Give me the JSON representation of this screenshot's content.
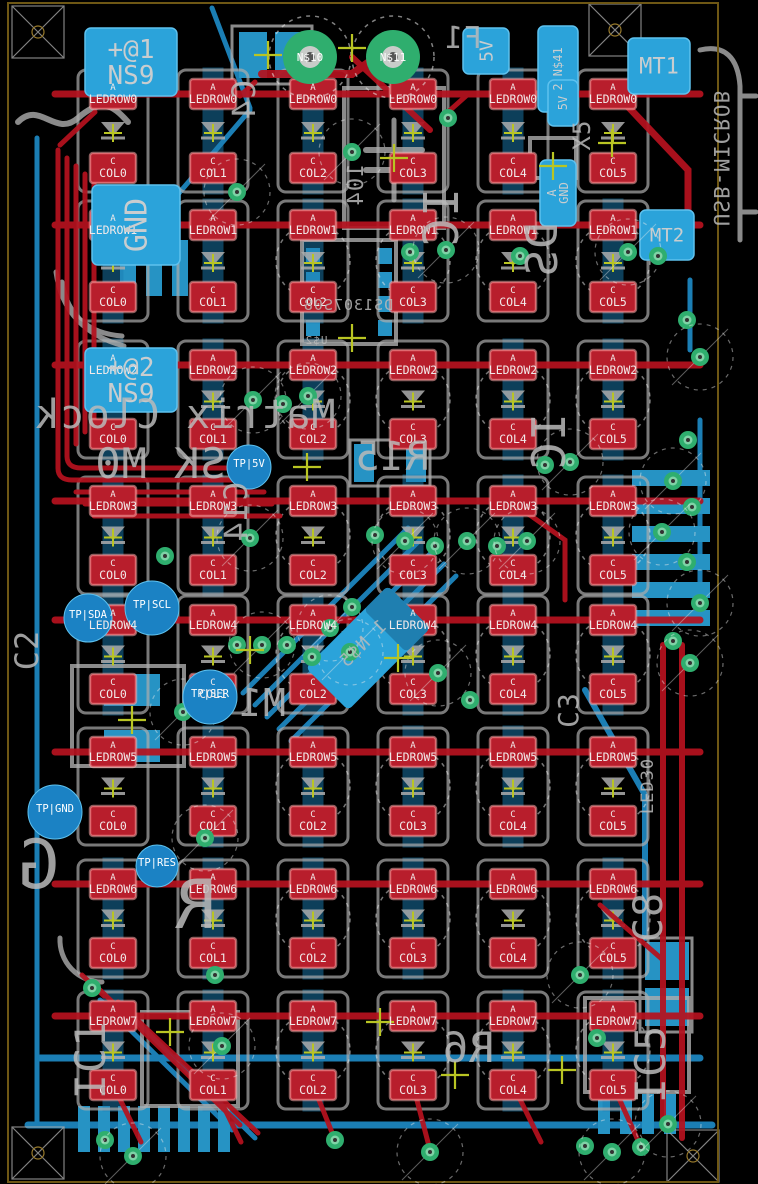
{
  "app": {
    "description": "PCB layout editor view of LED matrix clock board"
  },
  "colors": {
    "background": "#000000",
    "top_copper": "#b5121f",
    "pad_red": "#b81e2c",
    "bottom_copper": "#1e8cc8",
    "pad_blue": "#2ba3da",
    "silk": "#adadad",
    "via_green": "#2fae6e",
    "outline_yellow": "#8a6d1a",
    "origin_olive": "#b9c523",
    "tp_blue": "#1b82c4",
    "label_white": "#f2eaea"
  },
  "board": {
    "outline": {
      "x": 8,
      "y": 3,
      "w": 710,
      "h": 1179
    }
  },
  "grid": {
    "anode_prefix": "A",
    "cathode_prefix": "C",
    "rows": [
      "LEDROW0",
      "LEDROW1",
      "LEDROW2",
      "LEDROW3",
      "LEDROW4",
      "LEDROW5",
      "LEDROW6",
      "LEDROW7"
    ],
    "cols": [
      "COL0",
      "COL1",
      "COL2",
      "COL3",
      "COL4",
      "COL5"
    ],
    "col_x": [
      113,
      213,
      313,
      413,
      513,
      613
    ],
    "anode_y": [
      94,
      225,
      365,
      501,
      620,
      752,
      884,
      1016
    ],
    "cathode_y": [
      168,
      297,
      434,
      570,
      689,
      821,
      953,
      1085
    ]
  },
  "named_pads": [
    {
      "id": "ns9-1",
      "label": "+@1|NS9",
      "x": 85,
      "y": 28,
      "w": 92,
      "h": 68,
      "rot": 0,
      "size": 26
    },
    {
      "id": "gnd",
      "label": "GND",
      "x": 92,
      "y": 185,
      "w": 88,
      "h": 80,
      "rot": -90,
      "size": 30
    },
    {
      "id": "ns9-2",
      "label": "+@2|NS9",
      "x": 85,
      "y": 348,
      "w": 92,
      "h": 64,
      "rot": 0,
      "size": 26
    },
    {
      "id": "pwr-5v",
      "label": "5V",
      "x": 463,
      "y": 28,
      "w": 46,
      "h": 46,
      "rot": -90,
      "size": 18
    },
    {
      "id": "ns41",
      "label": "2 N$41",
      "x": 538,
      "y": 26,
      "w": 40,
      "h": 86,
      "rot": -90,
      "size": 12
    },
    {
      "id": "usb-5v",
      "label": "5V",
      "x": 548,
      "y": 80,
      "w": 30,
      "h": 46,
      "rot": -90,
      "size": 12
    },
    {
      "id": "usb-gnd",
      "label": "A|GND",
      "x": 540,
      "y": 160,
      "w": 36,
      "h": 66,
      "rot": -90,
      "size": 12
    },
    {
      "id": "mt1",
      "label": "MT1",
      "x": 628,
      "y": 38,
      "w": 62,
      "h": 56,
      "rot": 0,
      "size": 22
    },
    {
      "id": "mt2",
      "label": "MT2",
      "x": 640,
      "y": 210,
      "w": 54,
      "h": 50,
      "rot": 0,
      "size": 19
    }
  ],
  "test_points": [
    {
      "label": "TP|5V",
      "x": 249,
      "y": 467,
      "r": 22
    },
    {
      "label": "TP|SDA",
      "x": 88,
      "y": 618,
      "r": 24
    },
    {
      "label": "TP|SCL",
      "x": 152,
      "y": 608,
      "r": 27
    },
    {
      "label": "TP|SER",
      "x": 210,
      "y": 697,
      "r": 27
    },
    {
      "label": "TP|GND",
      "x": 55,
      "y": 812,
      "r": 27
    },
    {
      "label": "TP|RES",
      "x": 157,
      "y": 866,
      "r": 21
    }
  ],
  "holes": [
    {
      "label": "N$10",
      "x": 310,
      "y": 57,
      "r": 27
    },
    {
      "label": "N$11",
      "x": 393,
      "y": 57,
      "r": 27
    }
  ],
  "silk_texts": [
    {
      "text": "Matrix Clock",
      "x": 185,
      "y": 428,
      "size": 40,
      "rot": 0,
      "mirror": true
    },
    {
      "text": "SK M0",
      "x": 160,
      "y": 478,
      "size": 42,
      "rot": 0,
      "mirror": true
    },
    {
      "text": "C4",
      "x": 255,
      "y": 100,
      "size": 32,
      "rot": -90,
      "mirror": true
    },
    {
      "text": "F1",
      "x": 463,
      "y": 48,
      "size": 30,
      "rot": 0,
      "mirror": true
    },
    {
      "text": "104",
      "x": 363,
      "y": 185,
      "size": 22,
      "rot": -90,
      "mirror": true
    },
    {
      "text": "DS1307S08",
      "x": 348,
      "y": 310,
      "size": 15,
      "rot": 0,
      "mirror": true
    },
    {
      "text": "U$2",
      "x": 316,
      "y": 344,
      "size": 11,
      "rot": 0,
      "mirror": true
    },
    {
      "text": "IC",
      "x": 458,
      "y": 218,
      "size": 48,
      "rot": -90,
      "mirror": true
    },
    {
      "text": "DS",
      "x": 557,
      "y": 250,
      "size": 44,
      "rot": -90,
      "mirror": true
    },
    {
      "text": "C14",
      "x": 247,
      "y": 512,
      "size": 32,
      "rot": -90,
      "mirror": true
    },
    {
      "text": "R15",
      "x": 392,
      "y": 470,
      "size": 40,
      "rot": 0,
      "mirror": true
    },
    {
      "text": "IC",
      "x": 565,
      "y": 442,
      "size": 46,
      "rot": -90,
      "mirror": true
    },
    {
      "text": "1 N$5",
      "x": 367,
      "y": 648,
      "size": 18,
      "rot": -45,
      "mirror": true
    },
    {
      "text": "M1",
      "x": 262,
      "y": 716,
      "size": 38,
      "rot": 0,
      "mirror": true
    },
    {
      "text": "C2",
      "x": 38,
      "y": 650,
      "size": 32,
      "rot": -90,
      "mirror": false
    },
    {
      "text": "C3",
      "x": 578,
      "y": 710,
      "size": 28,
      "rot": -90,
      "mirror": false
    },
    {
      "text": "LED30",
      "x": 653,
      "y": 786,
      "size": 17,
      "rot": -90,
      "mirror": false
    },
    {
      "text": "G",
      "x": 38,
      "y": 888,
      "size": 68,
      "rot": 0,
      "mirror": true
    },
    {
      "text": "R",
      "x": 195,
      "y": 928,
      "size": 68,
      "rot": 0,
      "mirror": true
    },
    {
      "text": "C8",
      "x": 662,
      "y": 917,
      "size": 40,
      "rot": -90,
      "mirror": false
    },
    {
      "text": "IC5",
      "x": 665,
      "y": 1064,
      "size": 42,
      "rot": -90,
      "mirror": false
    },
    {
      "text": "IC1",
      "x": 105,
      "y": 1060,
      "size": 42,
      "rot": -90,
      "mirror": false
    },
    {
      "text": "R6",
      "x": 468,
      "y": 1062,
      "size": 42,
      "rot": 0,
      "mirror": true
    },
    {
      "text": "X5",
      "x": 590,
      "y": 135,
      "size": 24,
      "rot": -90,
      "mirror": false
    },
    {
      "text": "USB-MICROB",
      "x": 714,
      "y": 158,
      "size": 21,
      "rot": 90,
      "mirror": true
    }
  ]
}
